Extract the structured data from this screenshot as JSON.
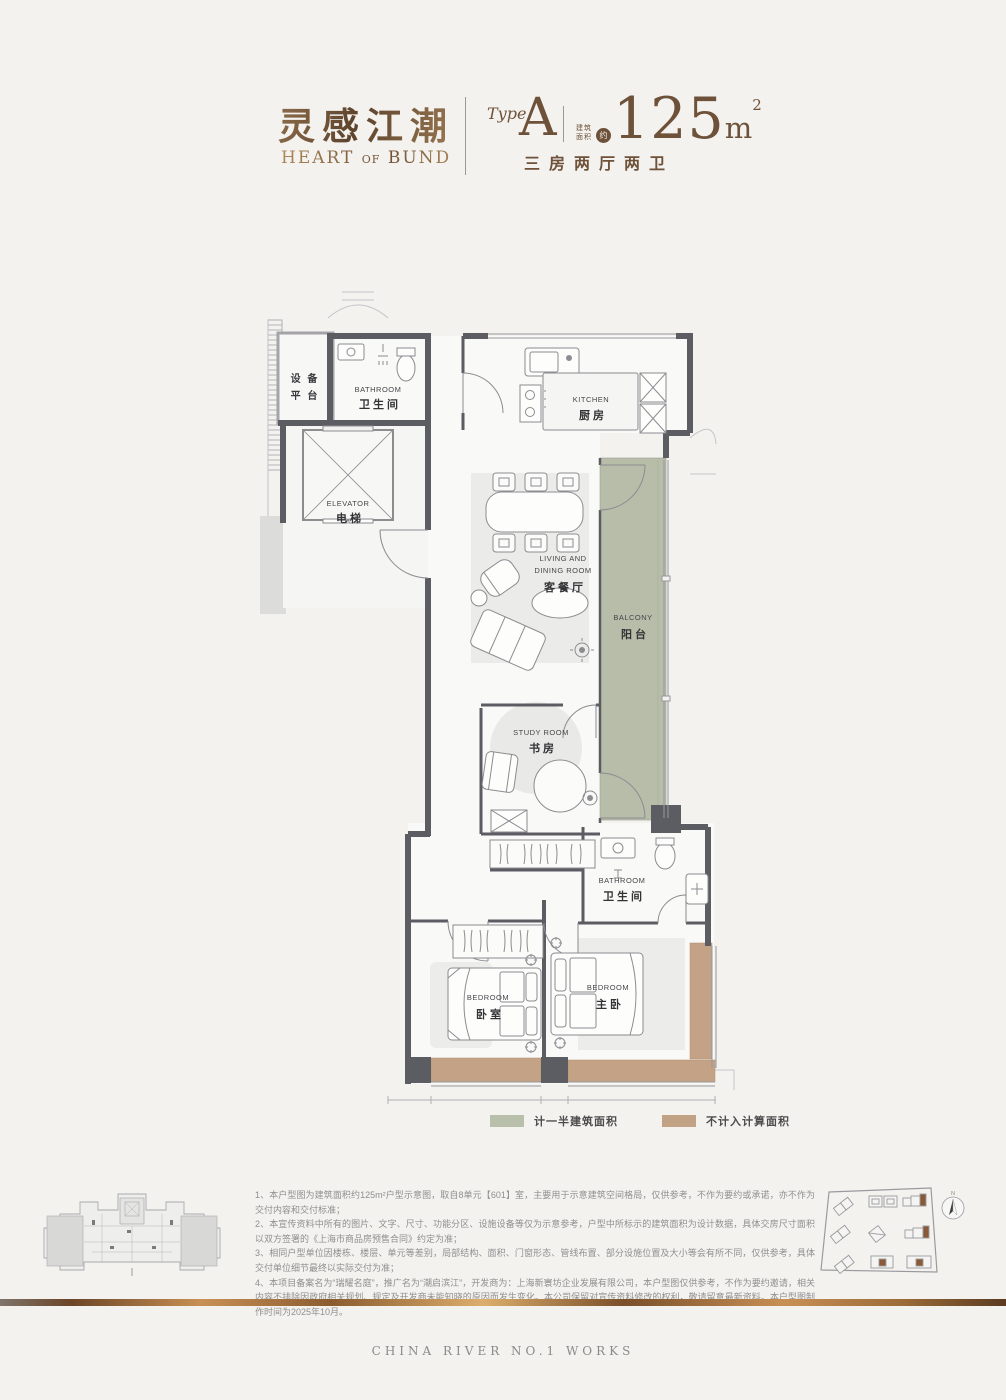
{
  "header": {
    "title_zh": "灵感江潮",
    "title_en1": "HEART",
    "title_en2": "OF",
    "title_en3": "BUND",
    "type_label": "Type",
    "type_value": "A",
    "area_label_line1": "建筑",
    "area_label_line2": "面积",
    "area_approx": "约",
    "area_number": "125",
    "area_unit": "m",
    "area_sup": "2",
    "layout_text": "三房两厅两卫"
  },
  "plan": {
    "rooms": {
      "equipment": {
        "zh_line1": "设 备",
        "zh_line2": "平 台"
      },
      "bathroom1": {
        "en": "BATHROOM",
        "zh": "卫生间"
      },
      "kitchen": {
        "en": "KITCHEN",
        "zh": "厨房"
      },
      "elevator": {
        "en": "ELEVATOR",
        "zh": "电梯"
      },
      "living": {
        "en_line1": "LIVING AND",
        "en_line2": "DINING ROOM",
        "zh": "客餐厅"
      },
      "balcony": {
        "en": "BALCONY",
        "zh": "阳台"
      },
      "study": {
        "en": "STUDY ROOM",
        "zh": "书房"
      },
      "bathroom2": {
        "en": "BATHROOM",
        "zh": "卫生间"
      },
      "bedroom": {
        "en": "BEDROOM",
        "zh": "卧室"
      },
      "master": {
        "en": "BEDROOM",
        "zh": "主卧"
      }
    },
    "colors": {
      "half_area_fill": "#b8bfab",
      "excluded_fill": "#c2a284",
      "wall": "#5c5c63"
    }
  },
  "legend": {
    "items": [
      {
        "label": "计一半建筑面积",
        "color": "#b8bfab"
      },
      {
        "label": "不计入计算面积",
        "color": "#c2a284"
      }
    ]
  },
  "notes": [
    "1、本户型图为建筑面积约125m²户型示意图，取自8单元【601】室，主要用于示意建筑空间格局，仅供参考，不作为要约或承诺，亦不作为交付内容和交付标准；",
    "2、本宣传资料中所有的图片、文字、尺寸、功能分区、设施设备等仅为示意参考，户型中所标示的建筑面积为设计数据，具体交房尺寸面积以双方签署的《上海市商品房预售合同》约定为准；",
    "3、相同户型单位因楼栋、楼层、单元等差别，局部结构、面积、门窗形态、管线布置、部分设施位置及大小等会有所不同，仅供参考，具体交付单位细节最终以实际交付为准；",
    "4、本项目备案名为“瑞耀名庭”，推广名为“潮启滨江”，开发商为：上海新寰坊企业发展有限公司，本户型图仅供参考，不作为要约邀请，相关内容不排除因政府相关规划、规定及开发商未能知晓的原因而发生变化。本公司保留对宣传资料修改的权利，敬请留意最新资料。本户型图制作时间为2025年10月。"
  ],
  "site_plan": {
    "compass_label": "N"
  },
  "footer": {
    "text": "CHINA RIVER NO.1 WORKS"
  }
}
